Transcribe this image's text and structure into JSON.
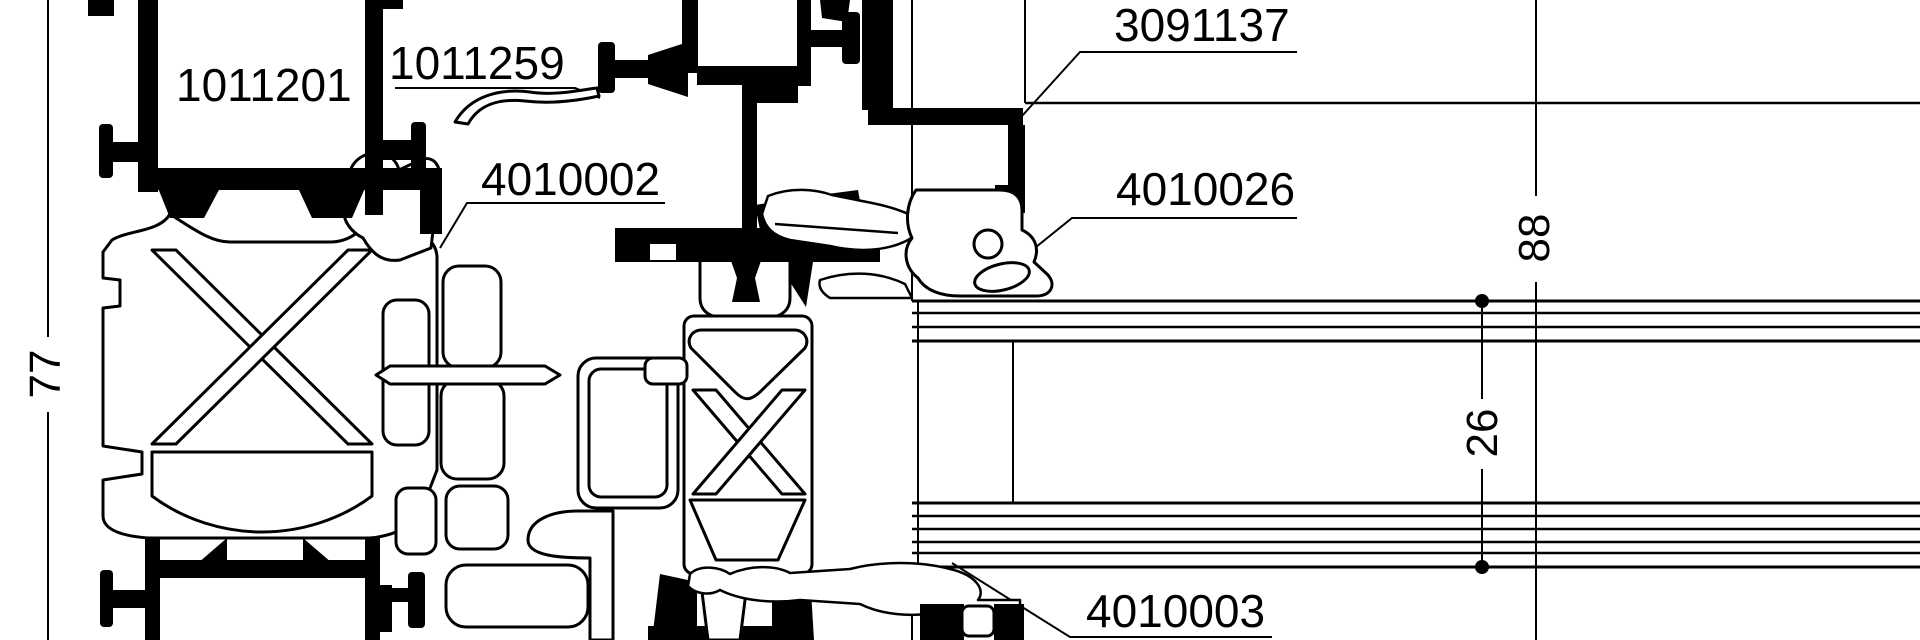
{
  "drawing": {
    "parts": {
      "frame_profile": "1011201",
      "sash_profile": "1011259",
      "insulating_strip": "4010002",
      "glazing_clamp": "3091137",
      "glazing_gasket": "4010026",
      "bottom_gasket": "4010003"
    },
    "dimensions": {
      "profile_depth": "77",
      "overall_height": "88",
      "glazing_unit": "26"
    },
    "colors": {
      "ink": "#000000",
      "paper": "#ffffff"
    }
  }
}
